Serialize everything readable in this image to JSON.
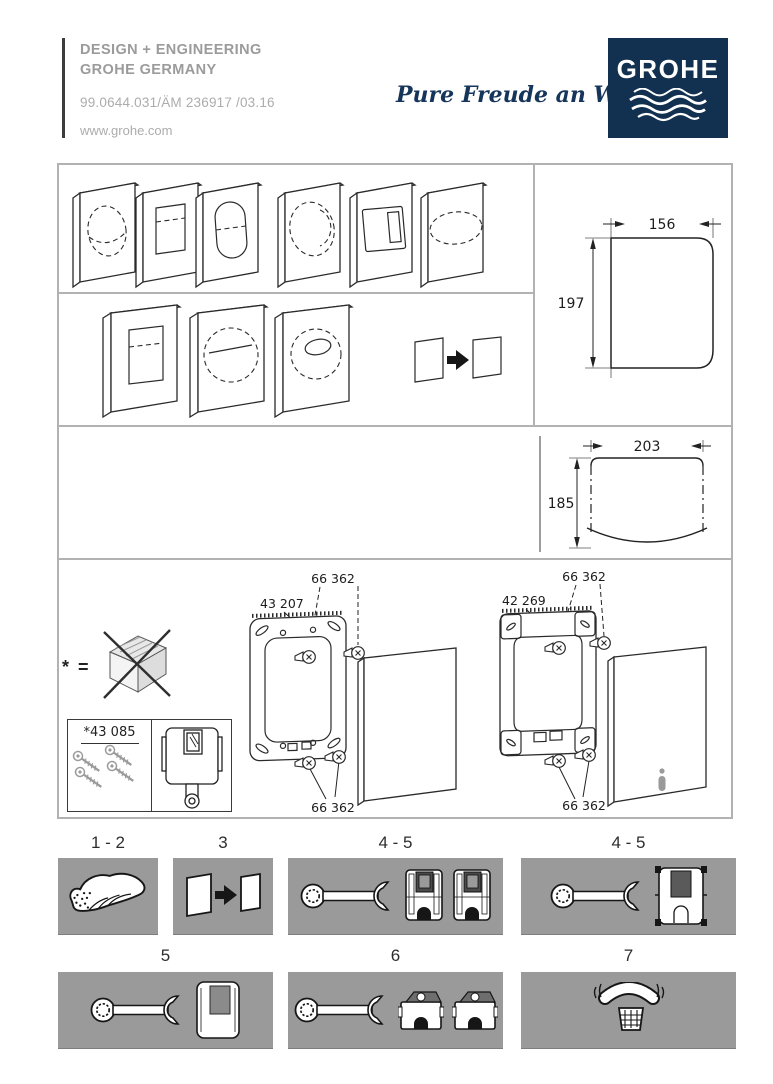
{
  "header": {
    "design_line1": "DESIGN + ENGINEERING",
    "design_line2": "GROHE GERMANY",
    "doc_number": "99.0644.031/ÄM 236917 /03.16",
    "website": "www.grohe.com",
    "slogan": "Pure Freude an Wasser",
    "brand": "GROHE",
    "brand_color": "#12304f"
  },
  "diagram": {
    "dim_small": {
      "width": "156",
      "height": "197"
    },
    "dim_large": {
      "width": "203",
      "height": "185"
    },
    "exploded_left": {
      "frame": "43 207",
      "screws_top": "66 362",
      "screws_bottom": "66 362"
    },
    "exploded_right": {
      "frame": "42 269",
      "screws_top": "66 362",
      "screws_bottom": "66 362"
    },
    "note_symbol": "* =",
    "kit_label": "*43 085"
  },
  "steps": {
    "panel_color": "#9a9a9a",
    "row1": [
      {
        "label": "1 - 2",
        "icon": "hand"
      },
      {
        "label": "3",
        "icon": "plate-swap"
      },
      {
        "label": "4 - 5",
        "icon": "wrench-two-cisterns"
      },
      {
        "label": "4 - 5",
        "icon": "wrench-frame"
      }
    ],
    "row2": [
      {
        "label": "5",
        "icon": "wrench-plate"
      },
      {
        "label": "6",
        "icon": "wrench-two-cisterns-top"
      },
      {
        "label": "7",
        "icon": "service-phone"
      }
    ]
  }
}
